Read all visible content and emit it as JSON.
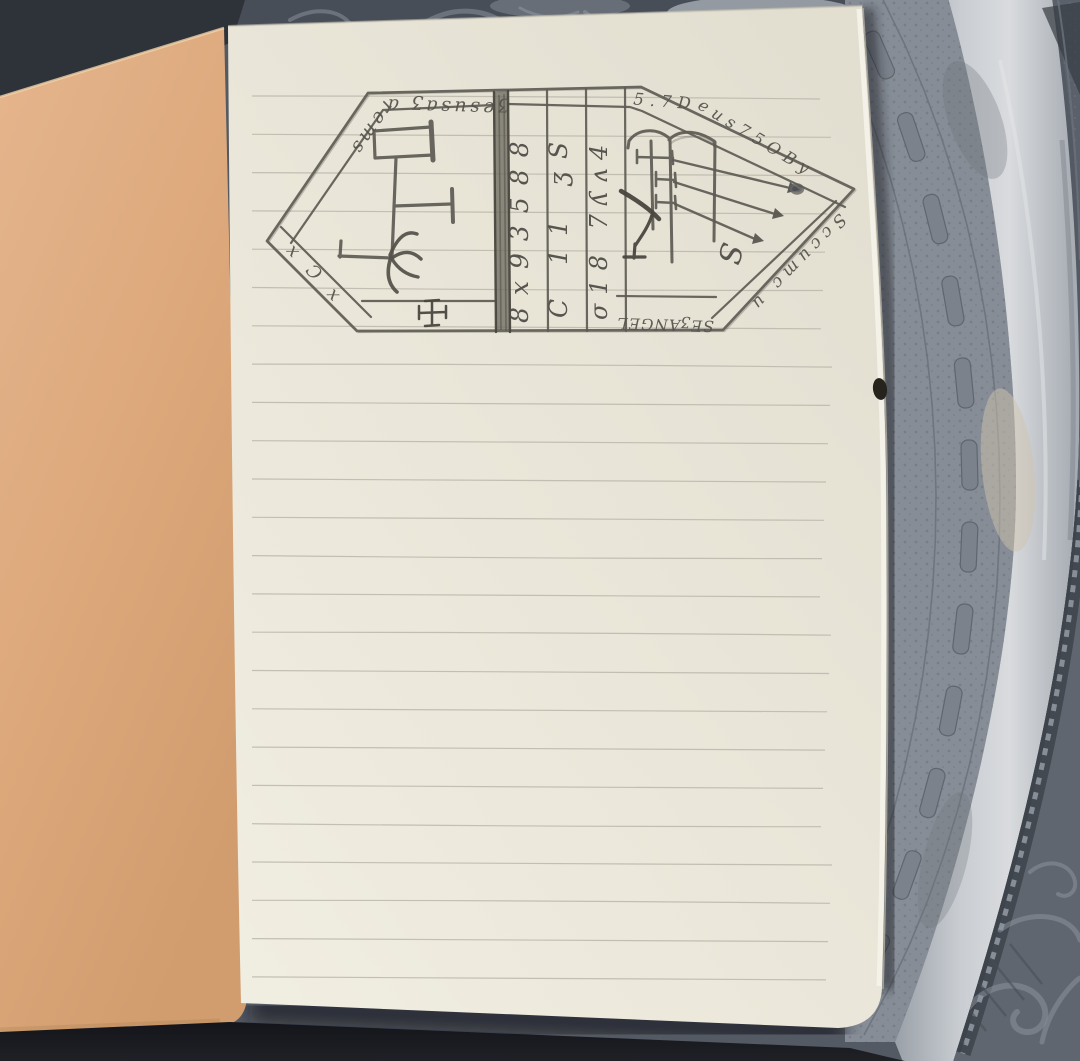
{
  "meta": {
    "title": "Pocket notebook with hand-drawn hexagonal sigil, lying on an engraved pewter tray"
  },
  "sigil": {
    "band_top_left": "ʒesusaʒ arems",
    "band_top_right": "5.7Deus75OBy",
    "band_right": "Sccumc u",
    "band_bottom": "SEʒANGELS",
    "band_lower_left": "x Ɔ x",
    "columns": {
      "c1": "8x93588",
      "c2": "C 11 ʒS",
      "c3": "σ18 7ʎʌ4"
    },
    "letter_s": "S",
    "cross_symbol": "✠"
  },
  "colors": {
    "page": "#ebe7da",
    "cover": "#ddab80",
    "rule_line": "#b8b4a7",
    "pencil": "#5d5b54",
    "tray_base": "#545a63",
    "tray_band_textured": "#868d96",
    "tray_band_bright": "#c7cbd0",
    "tray_dark": "#33383f",
    "shadow": "#15161a"
  }
}
